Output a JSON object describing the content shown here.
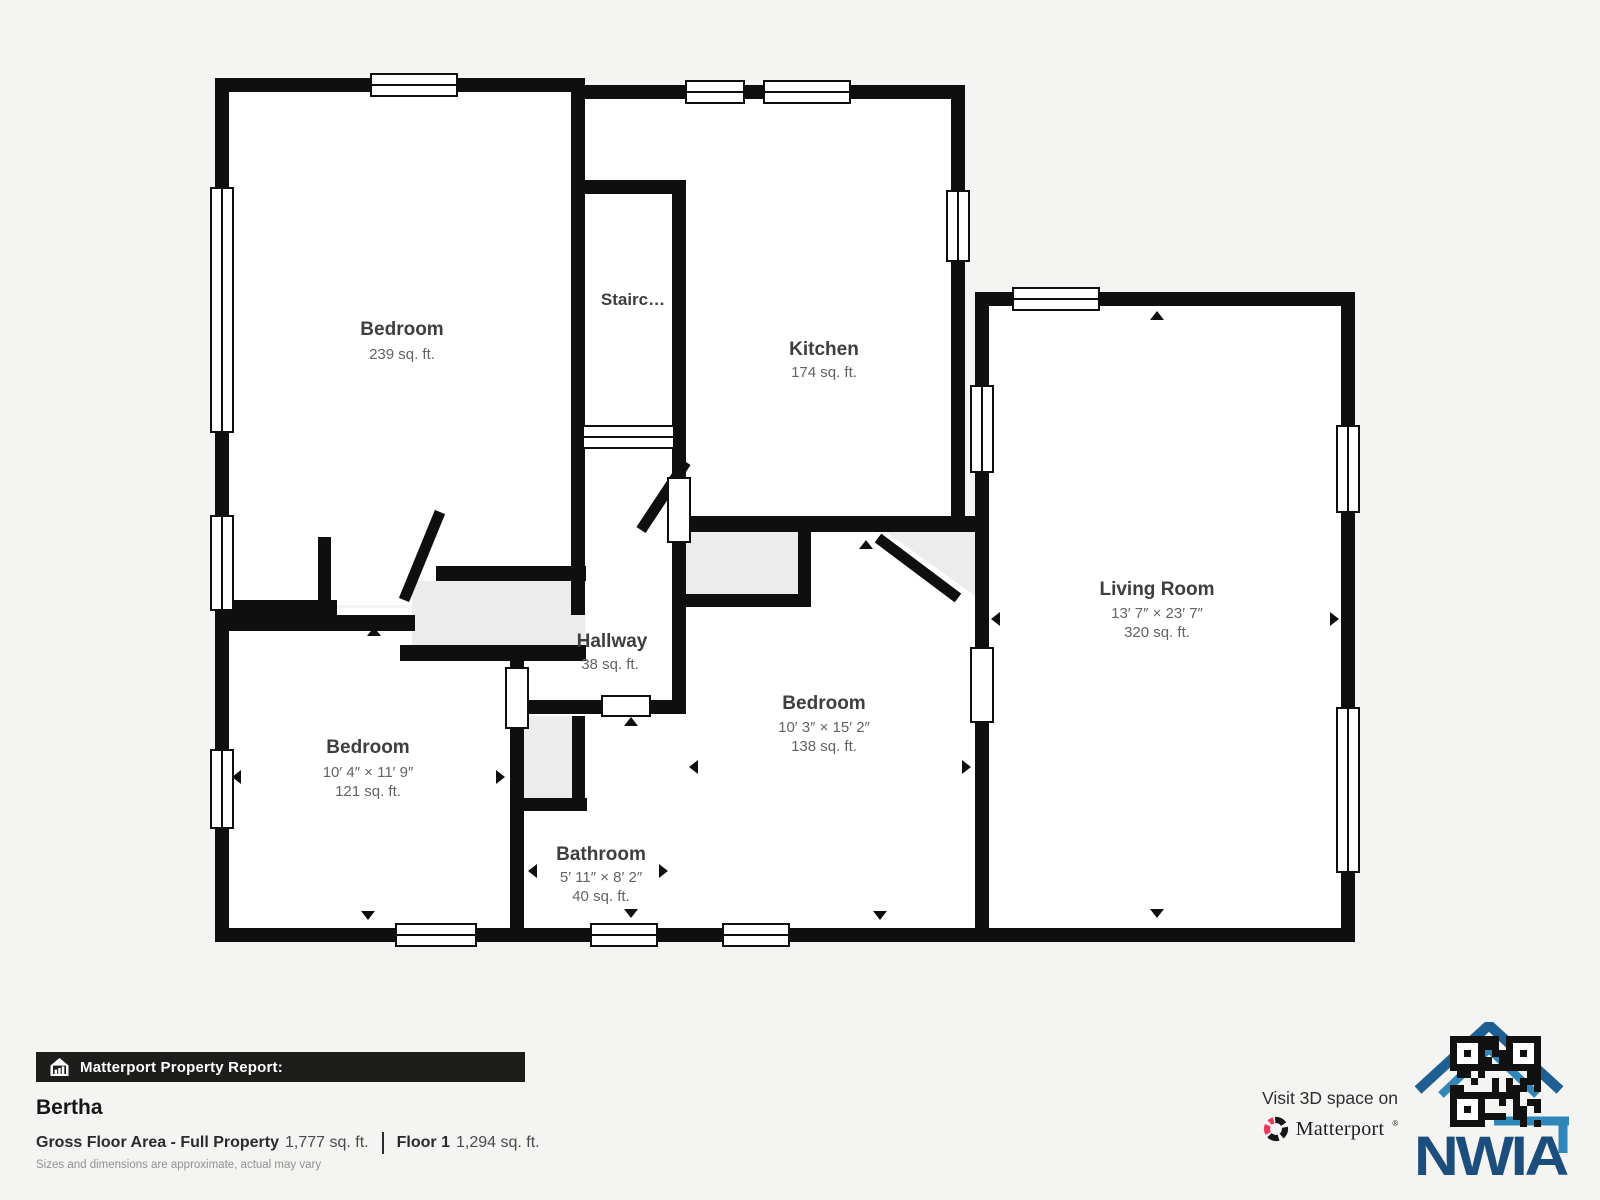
{
  "floorplan": {
    "rooms": [
      {
        "id": "bedroom-tl",
        "name": "Bedroom",
        "area": "239 sq. ft."
      },
      {
        "id": "staircase",
        "name": "Stairc…"
      },
      {
        "id": "kitchen",
        "name": "Kitchen",
        "area": "174 sq. ft."
      },
      {
        "id": "living-room",
        "name": "Living Room",
        "dims": "13′ 7″ × 23′ 7″",
        "area": "320 sq. ft."
      },
      {
        "id": "hallway",
        "name": "Hallway",
        "area": "38 sq. ft."
      },
      {
        "id": "bedroom-mid",
        "name": "Bedroom",
        "dims": "10′ 3″ × 15′ 2″",
        "area": "138 sq. ft."
      },
      {
        "id": "bedroom-bl",
        "name": "Bedroom",
        "dims": "10′ 4″ × 11′ 9″",
        "area": "121 sq. ft."
      },
      {
        "id": "bathroom",
        "name": "Bathroom",
        "dims": "5′ 11″ × 8′ 2″",
        "area": "40 sq. ft."
      }
    ]
  },
  "report": {
    "bar_label": "Matterport Property Report:",
    "property_name": "Bertha",
    "gross_label": "Gross Floor Area - Full Property",
    "gross_value": "1,777 sq. ft.",
    "floor_label": "Floor 1",
    "floor_value": "1,294 sq. ft.",
    "disclaimer": "Sizes and dimensions are approximate, actual may vary"
  },
  "promo": {
    "visit_text": "Visit 3D space on",
    "brand": "Matterport",
    "brand_mark": "®",
    "logo_text": "NWIA"
  },
  "colors": {
    "background": "#f4f4f2",
    "wall": "#0f0f0f",
    "room_fill": "#ffffff",
    "closet_fill": "#ececec",
    "bar_background": "#1d1d1b",
    "matterport_pink": "#f0385c",
    "nwia_blue_dark": "#1d5e93",
    "nwia_blue_light": "#2f86b8",
    "nwia_navy": "#1b4e7c"
  }
}
